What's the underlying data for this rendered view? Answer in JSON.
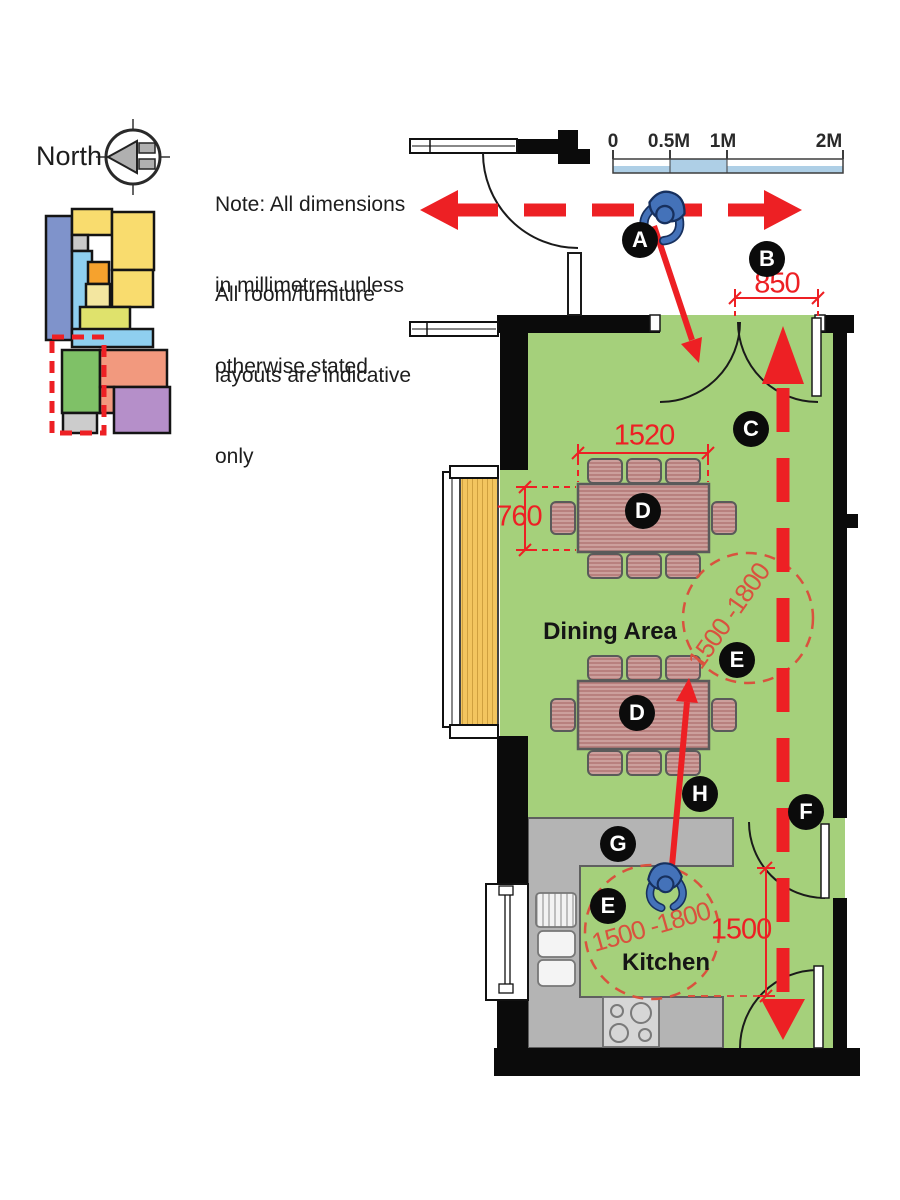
{
  "north": {
    "label": "North"
  },
  "notes": {
    "para1": [
      "Note: All dimensions",
      "in millimetres unless",
      "otherwise stated"
    ],
    "para2": [
      "All room/furniture",
      "layouts are indicative",
      "only"
    ]
  },
  "scale_bar": {
    "labels": [
      "0",
      "0.5M",
      "1M",
      "2M"
    ]
  },
  "plan": {
    "rooms": [
      {
        "name": "dining-area",
        "label": "Dining Area"
      },
      {
        "name": "kitchen",
        "label": "Kitchen"
      }
    ],
    "dimensions": [
      {
        "id": "entrance-door-width",
        "value": "850"
      },
      {
        "id": "dining-table-width",
        "value": "1520"
      },
      {
        "id": "dining-table-depth",
        "value": "760"
      },
      {
        "id": "kitchen-clearance",
        "value": "1500"
      },
      {
        "id": "turning-circle-dining",
        "value": "1500 -1800"
      },
      {
        "id": "turning-circle-kitchen",
        "value": "1500 -1800"
      }
    ],
    "markers": [
      {
        "label": "A"
      },
      {
        "label": "B"
      },
      {
        "label": "C"
      },
      {
        "label": "D"
      },
      {
        "label": "D"
      },
      {
        "label": "E"
      },
      {
        "label": "E"
      },
      {
        "label": "F"
      },
      {
        "label": "G"
      },
      {
        "label": "H"
      }
    ]
  },
  "icons": {
    "compass": "north-compass-icon",
    "person": "person-top-view-icon",
    "key_plan": "building-key-plan"
  },
  "colors": {
    "floor_green": "#a5d07b",
    "wall_black": "#0b0b0b",
    "accent_red": "#ed2024",
    "turning_circle_red": "#d9523e",
    "counter_gray": "#b4b4b4",
    "table_pink": "#c38e8a",
    "radiator_yellow": "#f3c55f",
    "person_blue": "#4472b9",
    "scale_blue": "#aecfe6",
    "key_plan_palette": [
      "#7f93cb",
      "#f9dc6e",
      "#8fcfef",
      "#f6a22d",
      "#dfe26c",
      "#7fc167",
      "#f2997e",
      "#b58fc9",
      "#cccccc"
    ]
  }
}
